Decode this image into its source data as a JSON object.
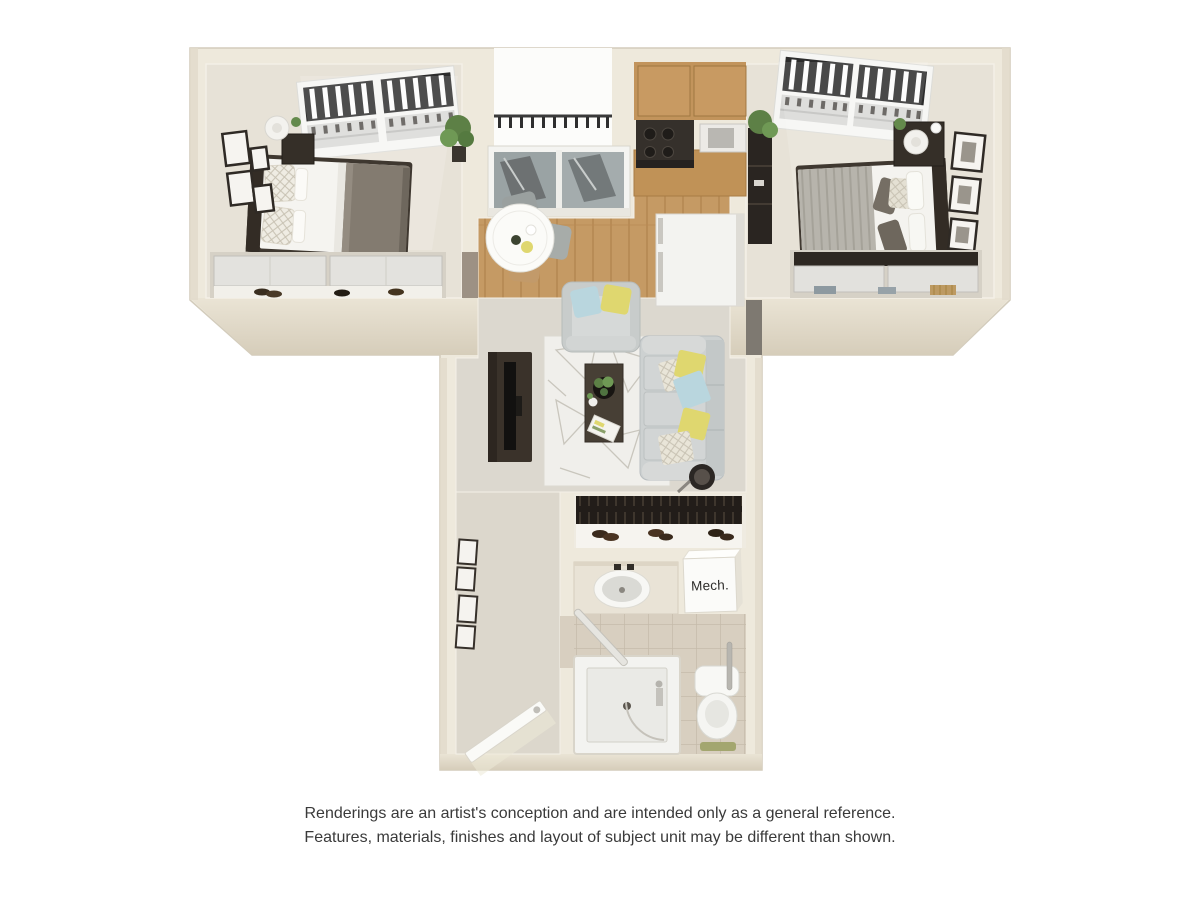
{
  "labels": {
    "mech_closet": "Mech."
  },
  "disclaimer": {
    "line1": "Renderings are an artist's conception and are intended only as a general reference.",
    "line2": "Features, materials, finishes and layout of subject unit may be different than shown."
  },
  "colors": {
    "wall": "#eee9dc",
    "wallshade": "#ddd5c3",
    "carpet": "#e7e2d7",
    "livingfloor": "#dcd8cf",
    "hallfloor": "#dcd7cc",
    "wood": "#c59a64",
    "tile": "#d8cfc0",
    "grout": "#c5bbaa",
    "rug": "#f0efeb",
    "sofa": "#cdd1d1",
    "darkwood": "#3a322a",
    "yellow": "#dfd76f",
    "blue": "#b9d6de",
    "green": "#648a4c",
    "fixture": "#f6f6f3",
    "text": "#3a3a3a"
  }
}
